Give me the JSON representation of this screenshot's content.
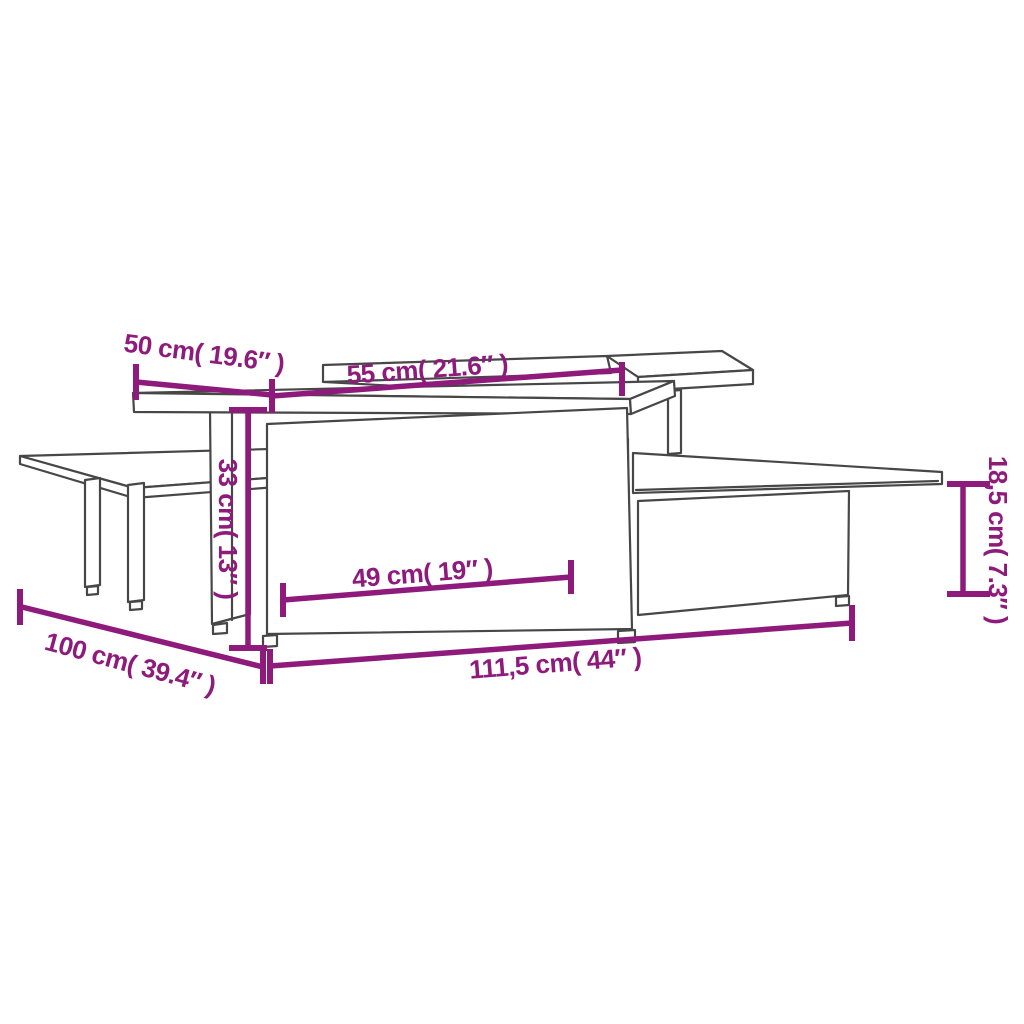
{
  "page": {
    "background": "#ffffff"
  },
  "colors": {
    "dimension": "#8E1B7C",
    "outline": "#474747"
  },
  "diagram": {
    "type": "furniture-dimension-drawing",
    "subject": "two interlocking coffee tables, isometric line drawing"
  },
  "dimensions": {
    "top_depth": {
      "label": "50 cm( 19.6″ )"
    },
    "top_width": {
      "label": "55 cm( 21.6″ )"
    },
    "height_tall": {
      "label": "33 cm( 13″ )"
    },
    "inner_width": {
      "label": "49 cm( 19″ )"
    },
    "height_low": {
      "label": "18,5 cm( 7.3″ )"
    },
    "total_depth": {
      "label": "100 cm( 39.4″ )"
    },
    "total_width": {
      "label": "111,5 cm( 44″ )"
    }
  }
}
